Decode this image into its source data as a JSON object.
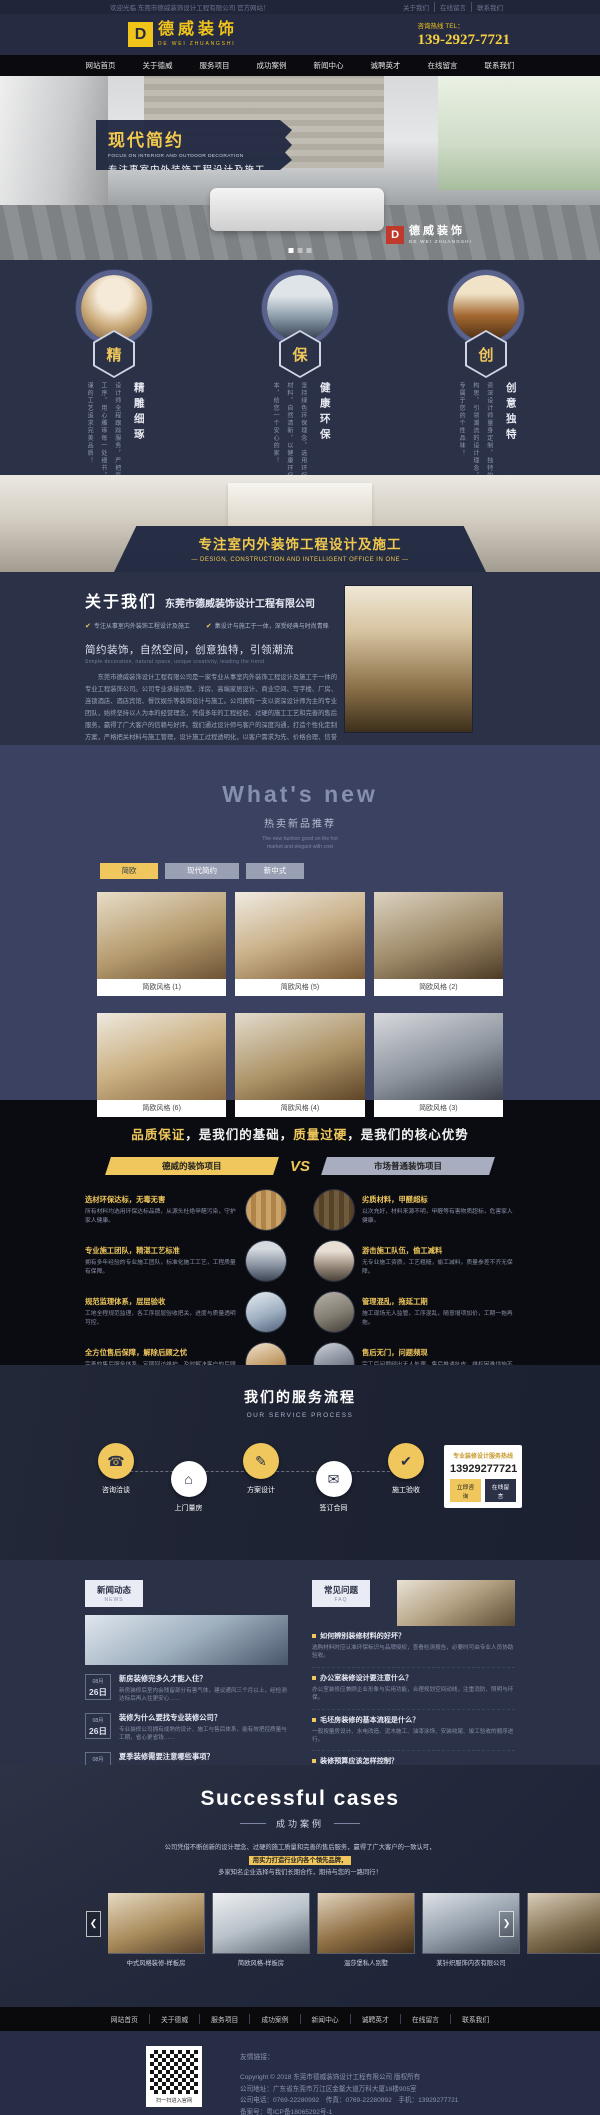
{
  "topbar": {
    "welcome": "欢迎光临 东莞市德威装饰设计工程有限公司 官方网站！",
    "links": [
      "关于我们",
      "在线留言",
      "联系我们"
    ]
  },
  "header": {
    "logo_mark": "D",
    "logo_cn": "德威装饰",
    "logo_en": "DE WEI ZHUANGSHI",
    "hotline_label": "咨询热线 TEL：",
    "phone": "139-2927-7721"
  },
  "nav": {
    "items": [
      "网站首页",
      "关于德威",
      "服务项目",
      "成功案例",
      "新闻中心",
      "诚聘英才",
      "在线留言",
      "联系我们"
    ]
  },
  "hero": {
    "title": "现代简约",
    "subtitle_en": "FOCUS ON INTERIOR AND OUTDOOR DECORATION",
    "subtitle_cn": "专注事室内外装饰工程设计及施工",
    "watermark_mark": "D",
    "watermark_cn": "德威装饰",
    "watermark_en": "DE WEI ZHUANGSHI"
  },
  "features": {
    "items": [
      {
        "char": "精",
        "title": "精雕细琢",
        "desc": "设计师全程跟踪服务，严把每一道工序，用心雕琢每一处细节，以严谨的工艺追求完美品质！"
      },
      {
        "char": "保",
        "title": "健康环保",
        "desc": "坚持绿色环保理念，选用环保达标材料，自然清新，以健康环保为根本，给您一个安心的家！"
      },
      {
        "char": "创",
        "title": "创意独特",
        "desc": "资深设计师量身定制，独特的创意构思，引领潮流的设计理念，彰显专属于您的个性品味！"
      }
    ]
  },
  "strip": {
    "title": "专注室内外装饰工程设计及施工",
    "subtitle": "—  DESIGN, CONSTRUCTION AND INTELLIGENT OFFICE IN ONE  —"
  },
  "about": {
    "title": "关于我们",
    "company": "东莞市德威装饰设计工程有限公司",
    "points": [
      "专注从事室内外装饰工程设计及施工",
      "集设计与施工于一体，深受经典与时尚青睐"
    ],
    "slogan": "简约装饰，自然空间，创意独特，引领潮流",
    "slogan_en": "Simple decoration, natural space, unique creativity, leading the trend",
    "paragraph": "东莞市德威装饰设计工程有限公司是一家专业从事室内外装饰工程设计及施工于一体的专业工程装饰公司。公司专业承接别墅、洋房、高端家居设计、商业空间、写字楼、厂房、连锁酒店、酒店宾馆、餐饮娱乐等装饰设计与施工。公司拥有一支以资深设计师为主的专业团队，始终坚持以人为本的经营理念，凭借多年的工程经验、过硬的施工工艺和完善的售后服务，赢得了广大客户的信赖与好评。我们通过设计师与客户的深度沟通，打造个性化定制方案，严格把关材料与施工管理，设计施工过程透明化，以客户需求为先、价格合理、信誉至上，竭诚为新老客户提供室内外装饰设计与施工于一体的一站式贴心服务。",
    "more": "查看更多"
  },
  "whatsnew": {
    "title": "What's new",
    "subtitle": "热卖新品推荐",
    "subtitle_en1": "The new fashion good on the hot",
    "subtitle_en2": "market and elegant with cost",
    "tabs": [
      "简欧",
      "现代简约",
      "新中式"
    ],
    "items": [
      "简欧风格 (1)",
      "简欧风格 (5)",
      "简欧风格 (2)",
      "简欧风格 (6)",
      "简欧风格 (4)",
      "简欧风格 (3)"
    ]
  },
  "compare": {
    "title": {
      "p1": "品质保证",
      "p2": "，是我们的基础，",
      "p3": "质量过硬",
      "p4": "，是我们的核心优势"
    },
    "left_ribbon": "德威的装饰项目",
    "vs": "VS",
    "right_ribbon": "市场普通装饰项目",
    "left_rows": [
      {
        "title": "选材环保达标，无毒无害",
        "desc": "所有材料均选用环保达标品牌，从源头杜绝甲醛污染，守护家人健康。"
      },
      {
        "title": "专业施工团队，精湛工艺标准",
        "desc": "拥有多年经验的专业施工团队，标准化施工工艺，工程质量有保障。"
      },
      {
        "title": "规范监理体系，层层验收",
        "desc": "工地全程规范监理，各工序层层验收把关，进度与质量透明可控。"
      },
      {
        "title": "全方位售后保障，解除后顾之忧",
        "desc": "完善的售后服务体系，定期回访维护，及时解决客户的后顾之忧。"
      }
    ],
    "right_rows": [
      {
        "title": "劣质材料，甲醛超标",
        "desc": "以次充好，材料来源不明，甲醛等有害物质超标，危害家人健康。"
      },
      {
        "title": "游击施工队伍，偷工减料",
        "desc": "无专业施工资质，工艺粗糙，偷工减料，质量参差不齐无保障。"
      },
      {
        "title": "管理混乱，拖延工期",
        "desc": "施工现场无人监管，工序混乱，随意增项加价，工期一拖再拖。"
      },
      {
        "title": "售后无门，问题频现",
        "desc": "完工后问题频出无人处理，售后推诿扯皮，维权困难烦恼不断。"
      }
    ]
  },
  "process": {
    "title": "我们的服务流程",
    "subtitle": "OUR SERVICE PROCESS",
    "steps": [
      {
        "icon": "☎",
        "label": "咨询洽谈"
      },
      {
        "icon": "⌂",
        "label": "上门量房"
      },
      {
        "icon": "✎",
        "label": "方案设计"
      },
      {
        "icon": "✉",
        "label": "签订合同"
      },
      {
        "icon": "✔",
        "label": "施工验收"
      }
    ],
    "hotline_title": "专业装修设计服务热线",
    "hotline_phone": "13929277721",
    "btn_consult": "立即咨询",
    "btn_message": "在线留言"
  },
  "news": {
    "tag": "新闻动态",
    "tag_en": "NEWS",
    "items": [
      {
        "month": "08月",
        "day": "26日",
        "title": "新房装修完多久才能入住？",
        "desc": "新房装修后室内会残留部分有害气体，建议通风三个月以上，经检测达标后再入住更安心……"
      },
      {
        "month": "08月",
        "day": "26日",
        "title": "装修为什么要找专业装修公司？",
        "desc": "专业装修公司拥有成熟的设计、施工与售后体系，能有效把控质量与工期，省心更省钱……"
      },
      {
        "month": "08月",
        "day": "26日",
        "title": "夏季装修需要注意哪些事项？",
        "desc": "夏季气温高、湿度大，材料存放与施工工艺都要格外注意防潮防晒，以免影响工程质量……"
      }
    ]
  },
  "faq": {
    "tag": "常见问题",
    "tag_en": "FAQ",
    "items": [
      {
        "q": "如何辨别装修材料的好坏？",
        "a": "选购材料时应认准环保标识与品牌授权，查看检测报告，必要时可由专业人员协助验收。"
      },
      {
        "q": "办公室装修设计要注意什么？",
        "a": "办公室装修应兼顾企业形象与实用功能，合理规划空间动线，注重消防、照明与环保。"
      },
      {
        "q": "毛坯房装修的基本流程是什么？",
        "a": "一般按量房设计、水电改造、泥木施工、油漆涂饰、安装收尾、竣工验收的顺序进行。"
      },
      {
        "q": "装修预算应该怎样控制？",
        "a": "先明确装修档次与需求，按设计方案列出材料与人工明细，预留5%-10%的机动费用。"
      }
    ]
  },
  "cases": {
    "title": "Successful cases",
    "subtitle": "成功案例",
    "para1": "公司凭借不断创新的设计理念、过硬的施工质量和完善的售后服务，赢得了广大客户的一致认可，",
    "para_highlight": "用实力打造行业内各个领先品牌，",
    "para2": "多家知名企业选择与我们长期合作，期待与您的一路同行！",
    "prev": "❮",
    "next": "❯",
    "items": [
      "中式风格装修-样板房",
      "简欧风格-样板房",
      "温莎堡私人别墅",
      "某针织服饰内衣有限公司"
    ]
  },
  "footer": {
    "qr_label": "扫一扫进入官网",
    "links_label": "友情链接：",
    "copyright": "Copyright © 2018 东莞市德威装饰设计工程有限公司 版权所有",
    "address": "公司地址：广东省东莞市万江区金鳌大道万科大厦18楼905室",
    "phones": "公司电话：0769-22280992　传真：0769-22280992　手机：13929277721",
    "icp": "备案号：粤ICP备18065292号-1"
  }
}
